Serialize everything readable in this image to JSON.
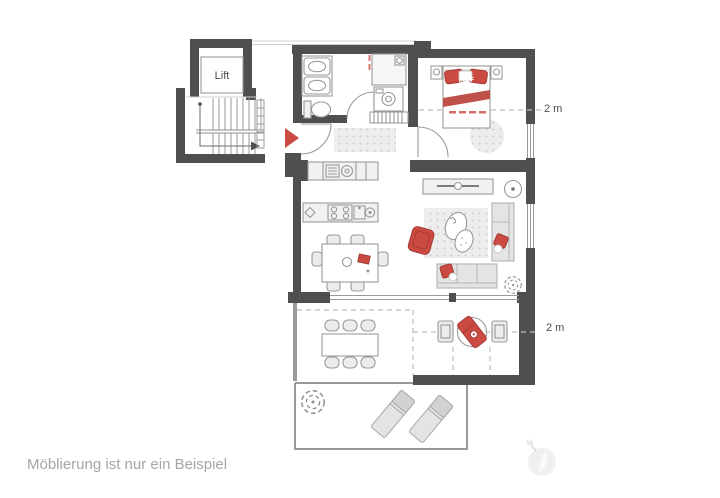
{
  "colors": {
    "wall": "#4f4f4f",
    "line": "#9a9a9a",
    "fill_light": "#ececec",
    "fill_mid": "#e4e4e4",
    "accent_red": "#cb4a41",
    "accent_red_dark": "#a53a33",
    "text_dark": "#4d4d4d",
    "text_gray": "#a6a6a6",
    "watermark": "#e3e3e3"
  },
  "floor_plan": {
    "caption": "Möblierung ist nur ein Beispiel",
    "labels": {
      "lift": "Lift",
      "bedroom_ceiling_height": "2 m",
      "balcony_ceiling_height": "2 m",
      "bed_print": "LOFF",
      "watermark_letter": "N"
    },
    "rooms": [
      "staircase",
      "lift",
      "bathroom",
      "hallway",
      "bedroom",
      "open-kitchen",
      "living-room",
      "balcony",
      "terrace"
    ],
    "furniture_symbols": {
      "bathroom": [
        "double-washbasin",
        "toilet",
        "shower",
        "washing-machine"
      ],
      "hallway": [
        "entrance-arrow",
        "doormat",
        "wardrobe"
      ],
      "bedroom": [
        "double-bed",
        "nightstand-left",
        "nightstand-right",
        "round-rug"
      ],
      "kitchen": [
        "wall-counter-appliances",
        "cooking-island",
        "dining-table-with-6-chairs"
      ],
      "living_room": [
        "sideboard-with-tv",
        "floor-lamp",
        "rug",
        "coffee-table",
        "red-armchair",
        "sofa-right",
        "sofa-bottom",
        "plant"
      ],
      "balcony": [
        "outdoor-table-with-6-chairs",
        "round-table",
        "red-lounger",
        "armchair-left",
        "armchair-right"
      ],
      "terrace": [
        "plant",
        "sun-lounger-1",
        "sun-lounger-2"
      ]
    }
  }
}
